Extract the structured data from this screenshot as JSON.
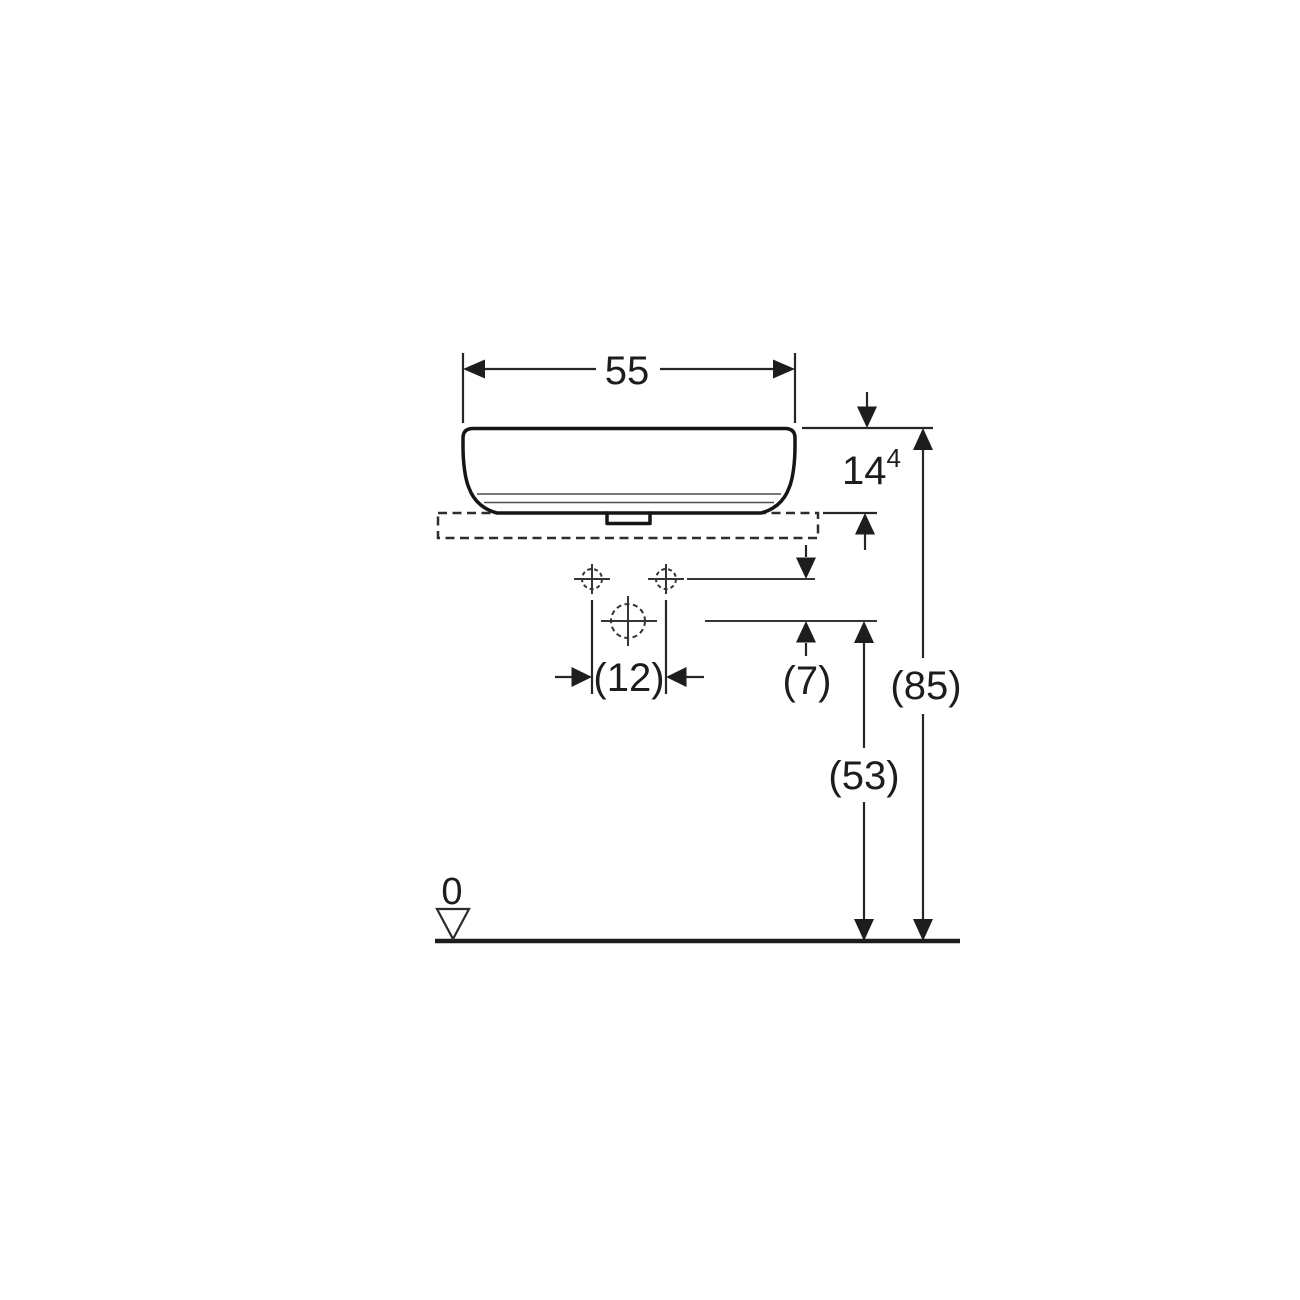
{
  "drawing": {
    "kind": "washbasin-elevation-dimension-drawing",
    "colors": {
      "line": "#1a1a1a",
      "thin_line": "#4f4f4f",
      "background": "#ffffff"
    },
    "dimensions": {
      "width": "55",
      "basin_height_main": "14",
      "basin_height_sup": "4",
      "hole_spacing": "(12)",
      "hole_row_offset": "(7)",
      "counter_axis_height": "(53)",
      "total_height": "(85)",
      "datum": "0"
    }
  }
}
